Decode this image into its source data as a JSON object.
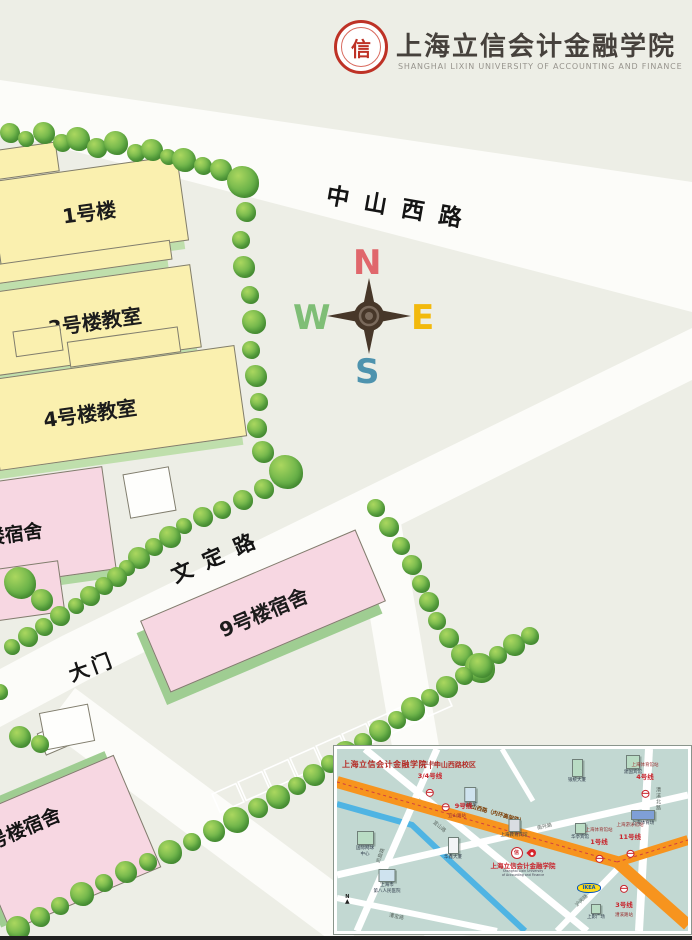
{
  "header": {
    "university_cn": "上海立信会计金融学院",
    "university_en": "SHANGHAI LIXIN UNIVERSITY OF ACCOUNTING AND FINANCE",
    "seal_char": "信"
  },
  "compass": {
    "n": "N",
    "e": "E",
    "s": "S",
    "w": "W"
  },
  "map": {
    "road_zhongshan": "中山西路",
    "road_wending": "文定路",
    "gate": "大门",
    "b1": "1号楼",
    "b3": "3号楼教室",
    "b4": "4号楼教室",
    "b9": "9号楼宿舍",
    "dorm_left": "楼宿舍",
    "dorm_bottom": "号楼宿舍"
  },
  "inset": {
    "title_cn": "上海立信会计金融学院",
    "title_campus": "中山西路校区",
    "university": {
      "name": "上海立信会计金融学院",
      "en1": "Shanghai Lixin University",
      "en2": "of Accounting and Finance"
    },
    "ikea": "IKEA",
    "north": "N",
    "stations": [
      {
        "x": 93,
        "y": 33,
        "station": "宜山路站",
        "line": "3/4号线",
        "layout": "v1"
      },
      {
        "x": 120,
        "y": 60,
        "station": "宜山路站",
        "line": "9号线",
        "layout": "v2"
      },
      {
        "x": 308,
        "y": 34,
        "station": "上海体育馆站",
        "line": "4号线",
        "layout": "v1"
      },
      {
        "x": 262,
        "y": 99,
        "station": "上海体育馆站",
        "line": "1号线",
        "layout": "v1"
      },
      {
        "x": 293,
        "y": 94,
        "station": "上海游泳馆站",
        "line": "11号线",
        "layout": "v1"
      },
      {
        "x": 287,
        "y": 150,
        "station": "漕溪路站",
        "line": "3号线",
        "layout": "v3"
      }
    ],
    "buildings": [
      {
        "x": 133,
        "y": 38,
        "w": 10,
        "h": 13,
        "color": "#cfe3ef",
        "lines": [
          "光启城"
        ]
      },
      {
        "x": 240,
        "y": 10,
        "w": 9,
        "h": 16,
        "color": "#b9dcc4",
        "lines": [
          "银统大厦"
        ]
      },
      {
        "x": 296,
        "y": 6,
        "w": 12,
        "h": 12,
        "color": "#b9dcc4",
        "lines": [
          "建国宾馆"
        ]
      },
      {
        "x": 177,
        "y": 70,
        "w": 10,
        "h": 11,
        "color": "#d9dde2",
        "lines": [
          "上海教育宾馆"
        ]
      },
      {
        "x": 116,
        "y": 88,
        "w": 9,
        "h": 15,
        "color": "#f2f4f6",
        "lines": [
          "华鑫大厦"
        ]
      },
      {
        "x": 28,
        "y": 82,
        "w": 15,
        "h": 12,
        "color": "#b9dcc4",
        "lines": [
          "国际网球",
          "中心"
        ]
      },
      {
        "x": 50,
        "y": 120,
        "w": 15,
        "h": 11,
        "color": "#cfe3ef",
        "lines": [
          "上海市",
          "第八人民医院"
        ]
      },
      {
        "x": 306,
        "y": 61,
        "w": 22,
        "h": 8,
        "color": "#7f9fd6",
        "lines": [
          "上海体育场"
        ]
      },
      {
        "x": 243,
        "y": 74,
        "w": 9,
        "h": 9,
        "color": "#b9dcc4",
        "lines": [
          "华亭宾馆"
        ]
      },
      {
        "x": 259,
        "y": 155,
        "w": 8,
        "h": 8,
        "color": "#b9dcc4",
        "lines": [
          "上影广场"
        ]
      }
    ],
    "road_labels": [
      {
        "x": 95,
        "y": 74,
        "rot": 40,
        "text": "宜山路"
      },
      {
        "x": 36,
        "y": 103,
        "rot": -70,
        "text": "凯旋路"
      },
      {
        "x": 318,
        "y": 38,
        "rot": 0,
        "text": "漕溪北路",
        "vert": true
      },
      {
        "x": 200,
        "y": 74,
        "rot": -13,
        "text": "南丹路"
      },
      {
        "x": 128,
        "y": 60,
        "rot": 16,
        "text": "中山西路（内环高架路）",
        "cls": "orange-label"
      },
      {
        "x": 52,
        "y": 164,
        "rot": 12,
        "text": "漕宝路"
      },
      {
        "x": 237,
        "y": 148,
        "rot": -44,
        "text": "沪闵路"
      }
    ]
  },
  "colors": {
    "bg": "#EDEEE6",
    "road_white": "#FCFCF9",
    "building_yellow": "#FAF0AF",
    "building_pink": "#F7D7E2",
    "building_shadow_green": "#BFDFAC",
    "tree_green": "#6AB249",
    "compass_n": "#E0676C",
    "compass_e": "#F2B90D",
    "compass_s": "#4E93AE",
    "compass_w": "#7FBE76",
    "inset_bg": "#C2D8D2",
    "orange_road": "#F7941E",
    "river_blue": "#4FB4E3",
    "metro_red": "#C8242C",
    "seal_red": "#BE3226"
  }
}
